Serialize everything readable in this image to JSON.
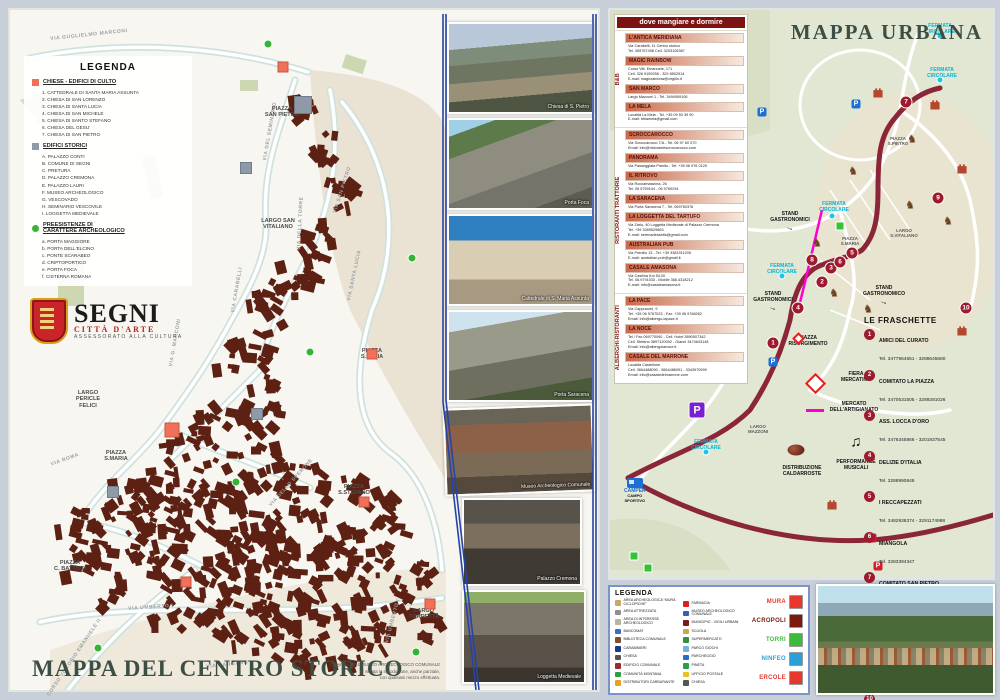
{
  "centro": {
    "title": "MAPPA DEL CENTRO STORICO",
    "copyright": "Copyright 2014 MUSEO ARCHEOLOGICO COMUNALE\nE' vietata la riproduzione, anche parziale,\ncon qualsiasi mezzo effettuata.",
    "legend": {
      "title": "LEGENDA",
      "churches": {
        "heading": "CHIESE - EDIFICI DI CULTO",
        "items": [
          "1.  CATTEDRALE DI SANTA MARIA ASSUNTA",
          "2.  CHIESA DI SAN LORENZO",
          "3.  CHIESA DI SANTA LUCIA",
          "4.  CHIESA DI SAN MICHELE",
          "5.  CHIESA DI SANTO STEFANO",
          "6.  CHIESA DEL GESU'",
          "7.  CHIESA DI SAN PIETRO"
        ]
      },
      "historic": {
        "heading": "EDIFICI STORICI",
        "items": [
          "A.  PALAZZO CONTI",
          "B.  COMUNE DI SEGNI",
          "C.  PRETURA",
          "D.  PALAZZO CREMONA",
          "E.  PALAZZO LAURI",
          "F.  MUSEO ARCHEOLOGICO",
          "G.  VESCOVADO",
          "H.  SEMINARIO VESCOVILE",
          "I.   LOGGETTA MEDIEVALE"
        ]
      },
      "archeo": {
        "heading": "PREESISTENZE DI\nCARATTERE ARCHEOLOGICO",
        "items": [
          "a.  PORTA MAGGIORE",
          "b.  PORTA DELL'ELCINO",
          "c.  PONTE SCARABEO",
          "d.  CRIPTOPORTICO",
          "e.  PORTA FOCA",
          "f.   CISTERNA ROMANA"
        ]
      }
    },
    "logo": {
      "title": "SEGNI",
      "subtitle": "CITTÀ D'ARTE",
      "dept": "ASSESSORATO ALLA CULTURA"
    },
    "street_labels": [
      {
        "text": "VIA GUGLIELMO MARCONI",
        "left": 40,
        "top": 26,
        "rot": -6
      },
      {
        "text": "VIA G. MARCONI",
        "left": 158,
        "top": 356,
        "rot": -80
      },
      {
        "text": "VIA DEL SEMINARIO",
        "left": 252,
        "top": 150,
        "rot": -80
      },
      {
        "text": "VIA DELLA TORRE",
        "left": 286,
        "top": 240,
        "rot": -87
      },
      {
        "text": "VIA SAN PIETRO",
        "left": 322,
        "top": 202,
        "rot": -72
      },
      {
        "text": "VIA SANTA LUCIA",
        "left": 336,
        "top": 290,
        "rot": -78
      },
      {
        "text": "VIA CARABELLI",
        "left": 220,
        "top": 302,
        "rot": -80
      },
      {
        "text": "VIA ROMA",
        "left": 40,
        "top": 452,
        "rot": -20
      },
      {
        "text": "VIA UMBERTO I",
        "left": 118,
        "top": 596,
        "rot": -4
      },
      {
        "text": "VIA UMBERTO I",
        "left": 374,
        "top": 632,
        "rot": -75
      },
      {
        "text": "CORSO VITTORIO EMANUELE II",
        "left": 36,
        "top": 684,
        "rot": -56
      },
      {
        "text": "VIA GARGANO",
        "left": 196,
        "top": 654,
        "rot": -6
      },
      {
        "text": "VIA DELLO SPERONE",
        "left": 258,
        "top": 494,
        "rot": -48
      }
    ],
    "plaza_labels": [
      {
        "text": "PIAZZA\nSAN PIETRO",
        "left": 272,
        "top": 96
      },
      {
        "text": "LARGO SAN\nVITALIANO",
        "left": 268,
        "top": 208
      },
      {
        "text": "PIAZZA\nS.LUCIA",
        "left": 362,
        "top": 338
      },
      {
        "text": "LARGO\nPERICLE\nFELICI",
        "left": 78,
        "top": 380
      },
      {
        "text": "PIAZZA\nS.MARIA",
        "left": 106,
        "top": 440
      },
      {
        "text": "PIAZZA\nC. BATTISTI",
        "left": 60,
        "top": 550
      },
      {
        "text": "PIAZZA\nS.STEFANO",
        "left": 344,
        "top": 474
      },
      {
        "text": "LARGO\nTORRETTA",
        "left": 414,
        "top": 598
      }
    ],
    "church_pts": [
      {
        "left": 273,
        "top": 57
      },
      {
        "left": 362,
        "top": 344
      },
      {
        "left": 162,
        "top": 420,
        "s": 13
      },
      {
        "left": 354,
        "top": 492
      },
      {
        "left": 176,
        "top": 572
      },
      {
        "left": 420,
        "top": 594
      }
    ],
    "historic_pts": [
      {
        "left": 293,
        "top": 95,
        "s": 16
      },
      {
        "left": 236,
        "top": 158
      },
      {
        "left": 247,
        "top": 404
      },
      {
        "left": 103,
        "top": 482
      }
    ],
    "archeo_pts": [
      {
        "left": 258,
        "top": 34
      },
      {
        "left": 402,
        "top": 248
      },
      {
        "left": 300,
        "top": 342
      },
      {
        "left": 226,
        "top": 472
      },
      {
        "left": 88,
        "top": 638
      },
      {
        "left": 406,
        "top": 642
      }
    ]
  },
  "photos": [
    {
      "caption": "Chiesa di S. Pietro"
    },
    {
      "caption": "Porta Foca"
    },
    {
      "caption": "Cattedrale di S. Maria Assunta"
    },
    {
      "caption": "Porta Saracena"
    },
    {
      "caption": "Museo Archeologico Comunale"
    },
    {
      "caption": "Palazzo Cremona"
    },
    {
      "caption": "Loggetta Medievale"
    }
  ],
  "urbana": {
    "title": "MAPPA URBANA",
    "dining": {
      "header": "dove mangiare e dormire",
      "groups": [
        {
          "label": "B&B",
          "entries": [
            {
              "name": "L'ANTICA MERIDIANA",
              "details": "Via Carabelli, 11 Centro storico\nTel. 069767498  Cell. 3293106367"
            },
            {
              "name": "MAGIC RAINBOW",
              "details": "Corso Vitt. Emanuele, 171\nCell. 326 9159256 - 329 8502914\nE-mail: magicrainbow@virgilio.it"
            },
            {
              "name": "SAN MARCO",
              "details": "Largo Mazzoni 1 - Tel. 3494959106"
            },
            {
              "name": "LA MELA",
              "details": "Località La Mela - Tel. +39 09 53 39 90\nE-mail: bblamela@gmail.com"
            }
          ]
        },
        {
          "label": "RISTORANTI TRATTORIE",
          "entries": [
            {
              "name": "SCROCCAROCCO",
              "details": "Via Scroccarocco 7/A - Tel. 06 97 60 070\nEmail: info@ristorantescroccarocco.com"
            },
            {
              "name": "PANORAMA",
              "details": "Via Passeggiata Pianito - Tel. +39 06 976 0129"
            },
            {
              "name": "IL RITROVO",
              "details": "Via Roccamassima, 26\nTel. 06 5769144 - 06 9769294"
            },
            {
              "name": "LA SARACENA",
              "details": "Via Porta Saracena 7 - Tel. 069760376"
            },
            {
              "name": "LA LOGGETTA DEL TARTUFO",
              "details": "Via Zarlo, 40 Loggetta Medievale di Palazzo Cremona\nTel. +39 3289529863\nE-mail: serenadesantis@gmail.com"
            },
            {
              "name": "AUSTRALIAN PUB",
              "details": "Via Prenilio 13 - Tel. +39 3381911205\nE-mail: australian.pub@gmail.it"
            },
            {
              "name": "CASALE AMASONA",
              "details": "Via Casilina Km 54,00\nTel. 06.9791033 - Mobile 366.4318212\nE-mail: info@casaleamasona.it"
            }
          ]
        },
        {
          "label": "ALBERGHI-RISTORANTI",
          "entries": [
            {
              "name": "LA PACE",
              "details": "Via Cappuccini, 9\nTel. +39 06 9767023 - Fax. +39 06 9766262\nEmail: info@albergo-lapace.it"
            },
            {
              "name": "LA NOCE",
              "details": "Tel / Fax 069770090 - Cell. Hotel 3890507342\nCell. Stefano 3897120002 - Gianni 3474643148\nEmail: info@albergolanoce.it"
            },
            {
              "name": "CASALE DEL MARRONE",
              "details": "Località Castellone\nCell. 3664488090 - 3664486091 - 3343970999\nEmail: info@casaledelmarrone.com"
            }
          ]
        }
      ]
    },
    "fraschette": {
      "title": "LE FRASCHETTE",
      "items": [
        {
          "n": "1",
          "name": "AMICI DEL CURATO",
          "tel": "Tel. 3477964651 - 3288645680"
        },
        {
          "n": "2",
          "name": "COMITATO LA PIAZZA",
          "tel": "Tel. 3470531505 - 3289281026"
        },
        {
          "n": "3",
          "name": "ASS. LOCCA D'ORO",
          "tel": "Tel. 3476345866 - 3201937545"
        },
        {
          "n": "4",
          "name": "DELIZIE D'ITALIA",
          "tel": "Tel. 3288990849"
        },
        {
          "n": "5",
          "name": "I RECCAPEZZATI",
          "tel": "Tel. 3482938374 - 3291174988"
        },
        {
          "n": "6",
          "name": "MIANGOLA",
          "tel": "Tel. 3283394347"
        },
        {
          "n": "7",
          "name": "COMITATO SAN PIETRO",
          "tel": "Tel. 3338234183 - 3884348319"
        },
        {
          "n": "8",
          "name": "DA MARCO \"I FREGNAQUANTI\"",
          "tel": "Tel. 3281814254 - 3247743182"
        },
        {
          "n": "9",
          "name": "ASS. PALLAVOLO SEGNI",
          "tel": "Tel. 3483309788 - 3280421541"
        },
        {
          "n": "10",
          "name": "LO SCARABEO",
          "tel": "Tel. 3473793974"
        }
      ]
    },
    "camper": {
      "label": "CAMPER",
      "sub": "CAMPO\nSPORTIVO"
    },
    "stands": [
      {
        "text": "STAND\nGASTRONOMICI",
        "left": 180,
        "top": 196
      },
      {
        "text": "STAND\nGASTRONOMICI",
        "left": 163,
        "top": 276
      },
      {
        "text": "STAND\nGASTRONOMICO",
        "left": 274,
        "top": 270
      }
    ],
    "ann_black": [
      {
        "text": "FIERA\nMERCATINO",
        "left": 246,
        "top": 362
      },
      {
        "text": "MERCATO\nDELL'ARTIGIANATO",
        "left": 244,
        "top": 392
      },
      {
        "text": "DISTRIBUZIONE\nCALDARROSTE",
        "left": 192,
        "top": 456
      },
      {
        "text": "PERFORMANCE\nMUSICALI",
        "left": 246,
        "top": 450
      },
      {
        "text": "PIAZZA\nRISORGIMENTO",
        "left": 198,
        "top": 326
      }
    ],
    "ann_cyan": [
      {
        "text": "FERMATA\nCIRCOLARE",
        "left": 224,
        "top": 192
      },
      {
        "text": "FERMATA\nCIRCOLARE",
        "left": 172,
        "top": 254
      },
      {
        "text": "FERMATA\nCIRCOLARE",
        "left": 332,
        "top": 58
      },
      {
        "text": "FERMATA\nCIRCOLARE",
        "left": 96,
        "top": 430
      },
      {
        "text": "FERMATA\nCIRCOLARE",
        "left": 330,
        "top": 14
      }
    ],
    "ann_map": [
      {
        "text": "PIAZZA\nS.PIETRO",
        "left": 288,
        "top": 126
      },
      {
        "text": "LARGO\nS.VITALIANO",
        "left": 294,
        "top": 218
      },
      {
        "text": "PIAZZA\nS.MARIA",
        "left": 240,
        "top": 226
      },
      {
        "text": "LARGO\nMAZZONI",
        "left": 148,
        "top": 414
      }
    ],
    "numbers": [
      {
        "n": "1",
        "left": 163,
        "top": 333
      },
      {
        "n": "2",
        "left": 212,
        "top": 272
      },
      {
        "n": "3",
        "left": 221,
        "top": 258
      },
      {
        "n": "4",
        "left": 188,
        "top": 298
      },
      {
        "n": "5",
        "left": 242,
        "top": 243
      },
      {
        "n": "6",
        "left": 230,
        "top": 252
      },
      {
        "n": "7",
        "left": 296,
        "top": 92
      },
      {
        "n": "8",
        "left": 202,
        "top": 250
      },
      {
        "n": "9",
        "left": 328,
        "top": 188
      },
      {
        "n": "10",
        "left": 356,
        "top": 298
      }
    ],
    "p_marks": [
      {
        "left": 246,
        "top": 94,
        "color": "#1d6fd1"
      },
      {
        "left": 152,
        "top": 102,
        "color": "#1d6fd1"
      },
      {
        "left": 163,
        "top": 352,
        "color": "#1d6fd1"
      },
      {
        "left": 262,
        "top": 528,
        "color": "#d11d2e"
      },
      {
        "left": 268,
        "top": 556,
        "color": "#d11d2e"
      }
    ],
    "castles": [
      {
        "left": 268,
        "top": 82
      },
      {
        "left": 325,
        "top": 94
      },
      {
        "left": 352,
        "top": 158
      },
      {
        "left": 222,
        "top": 494
      },
      {
        "left": 352,
        "top": 320
      }
    ],
    "horses": [
      {
        "left": 302,
        "top": 130
      },
      {
        "left": 338,
        "top": 212
      },
      {
        "left": 243,
        "top": 162
      },
      {
        "left": 207,
        "top": 234
      },
      {
        "left": 224,
        "top": 284
      },
      {
        "left": 258,
        "top": 300
      },
      {
        "left": 300,
        "top": 196
      }
    ],
    "greens": [
      {
        "left": 230,
        "top": 216
      },
      {
        "left": 24,
        "top": 546
      },
      {
        "left": 38,
        "top": 558
      }
    ],
    "cyandots": [
      {
        "left": 222,
        "top": 206
      },
      {
        "left": 172,
        "top": 266
      },
      {
        "left": 330,
        "top": 70
      },
      {
        "left": 96,
        "top": 442
      },
      {
        "left": 330,
        "top": 26
      }
    ],
    "diamonds": [
      {
        "left": 184,
        "top": 324,
        "s": 9
      },
      {
        "left": 198,
        "top": 366,
        "s": 15
      }
    ]
  },
  "blegend": {
    "title": "LEGENDA",
    "col1": [
      {
        "label": "AREA ARCHEOLOGICA \"MURA CICLOPICHE\"",
        "icon": "#c8a96a"
      },
      {
        "label": "AREA ATTREZZATA",
        "icon": "#8f8f8f"
      },
      {
        "label": "AREA DI INTERESSE ARCHEOLOGICO",
        "icon": "#b5b5a0"
      },
      {
        "label": "BANCOMAT",
        "icon": "#3a6fbf"
      },
      {
        "label": "BIBLIOTECA COMUNALE",
        "icon": "#7a5230"
      },
      {
        "label": "CARABINIERI",
        "icon": "#1a3a8f"
      },
      {
        "label": "CHIESA",
        "icon": "#555555"
      },
      {
        "label": "EDIFICIO COMUNALE",
        "icon": "#9e2b2b"
      },
      {
        "label": "COMUNITÀ MONTANA",
        "icon": "#2e9e44"
      },
      {
        "label": "DISTRIBUTORI CARBURANTE",
        "icon": "#e8a020"
      }
    ],
    "col2": [
      {
        "label": "FARMACIA",
        "icon": "#e02020"
      },
      {
        "label": "MUSEO ARCHEOLOGICO COMUNALE",
        "icon": "#3a5fae"
      },
      {
        "label": "MUNICIPIO - VIGILI URBANI",
        "icon": "#7a1a1a"
      },
      {
        "label": "SCUOLA",
        "icon": "#caa84a"
      },
      {
        "label": "SUPERMERCATO",
        "icon": "#3a8f3a"
      },
      {
        "label": "PARCO GIOCHI",
        "icon": "#7ab0d8"
      },
      {
        "label": "PARCHEGGIO",
        "icon": "#1d6fd1"
      },
      {
        "label": "PINETA",
        "icon": "#2e9e44"
      },
      {
        "label": "UFFICIO POSTALE",
        "icon": "#e8c020"
      },
      {
        "label": "CHIESA",
        "icon": "#555555"
      }
    ],
    "sites": [
      {
        "label": "MURA",
        "color": "#e8372c"
      },
      {
        "label": "ACROPOLI",
        "color": "#7a1a10"
      },
      {
        "label": "TORRI",
        "color": "#3dbb3d"
      },
      {
        "label": "NINFEO",
        "color": "#2a9fd8"
      },
      {
        "label": "ERCOLE",
        "color": "#e8372c"
      }
    ]
  }
}
